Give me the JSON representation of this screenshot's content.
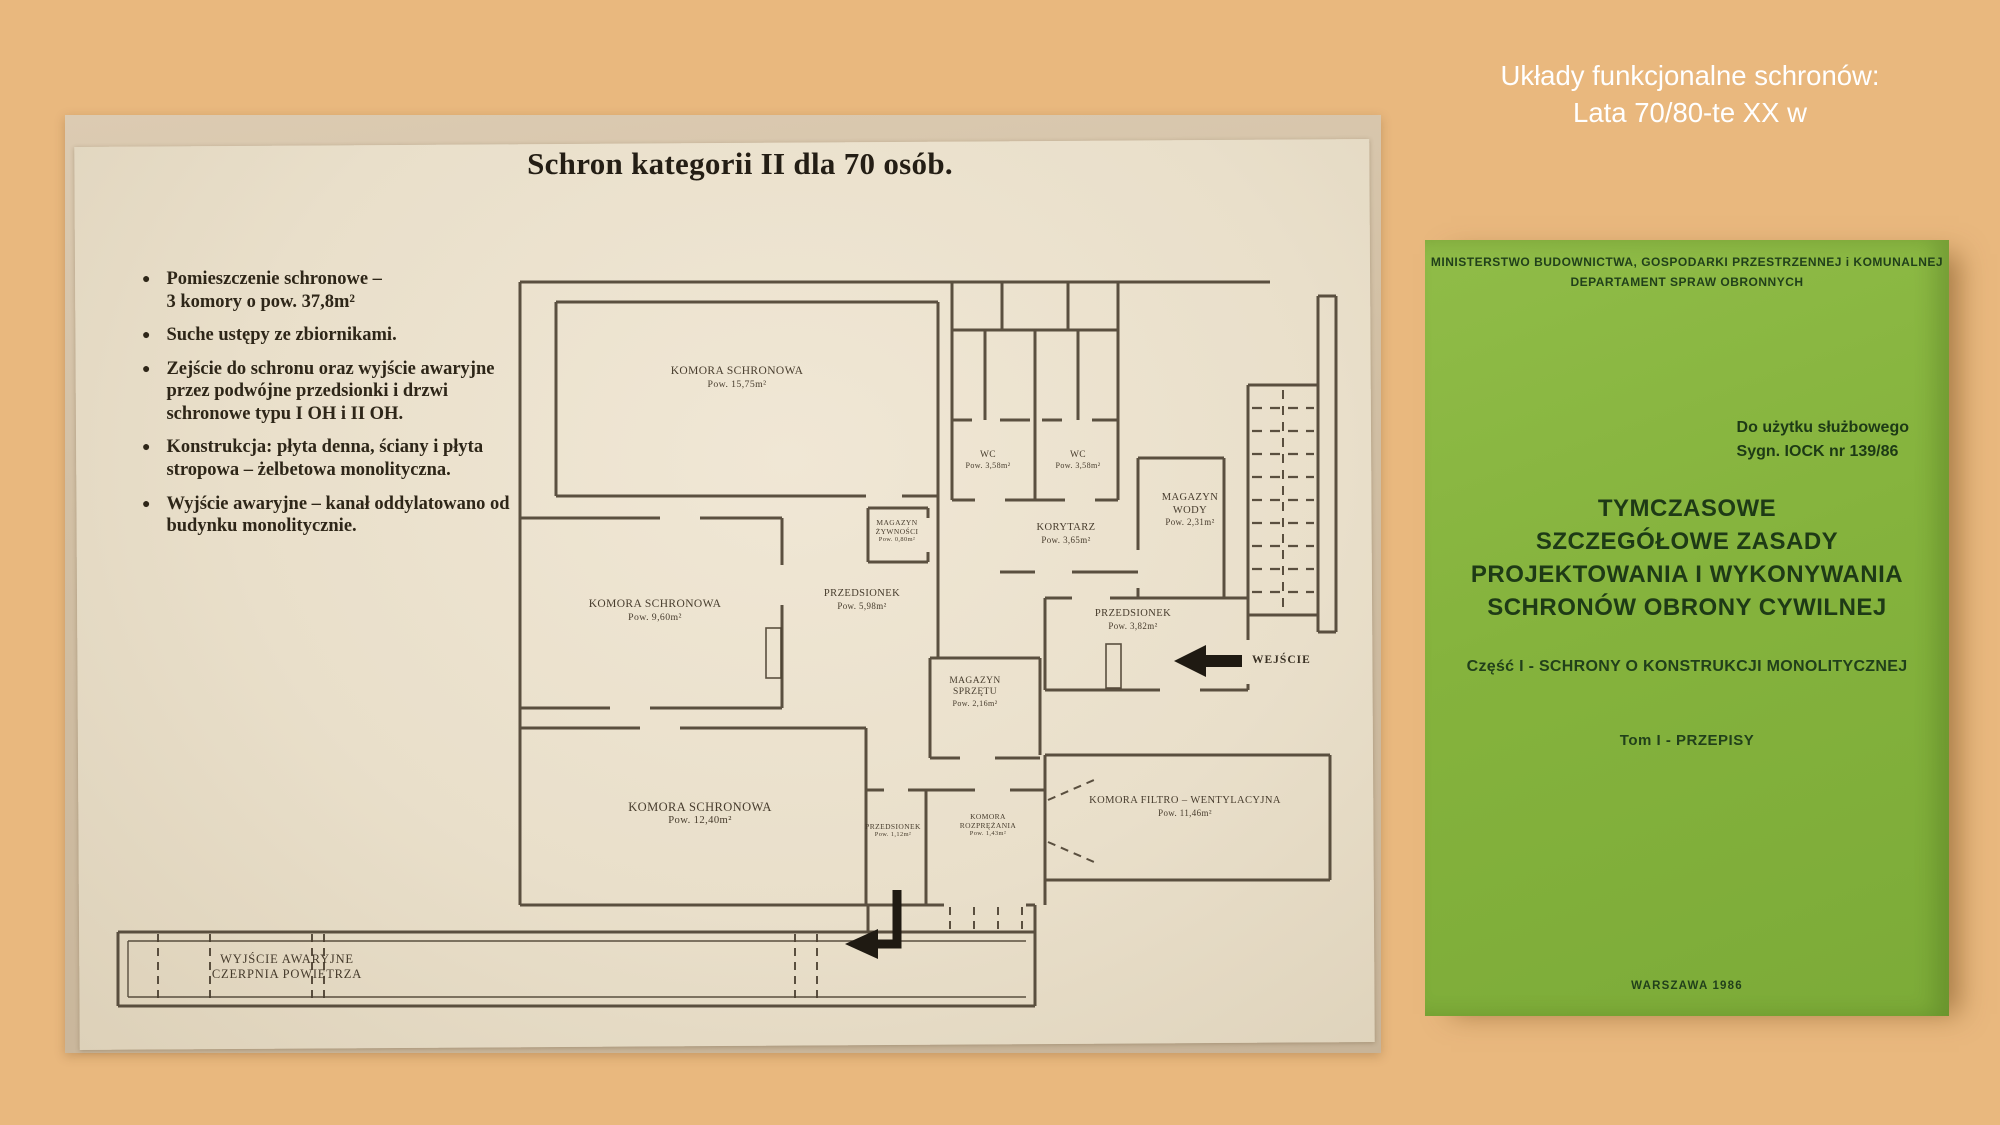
{
  "caption": {
    "line1": "Układy funkcjonalne schronów:",
    "line2": "Lata 70/80-te XX w"
  },
  "colors": {
    "page_bg": "#e9b87e",
    "cover_green": "#86b53e",
    "paper": "#e9dfca",
    "plan_ink": "#473c2d",
    "caption_text": "#ffffff"
  },
  "floorplan": {
    "title": "Schron kategorii II dla 70 osób.",
    "bullets": [
      "Pomieszczenie schronowe –\n3 komory o pow. 37,8m²",
      "Suche ustępy ze zbiornikami.",
      "Zejście do schronu oraz wyjście awaryjne\nprzez podwójne przedsionki i drzwi\nschronowe typu I OH i II OH.",
      "Konstrukcja: płyta denna, ściany i płyta\nstropowa – żelbetowa monolityczna.",
      "Wyjście awaryjne – kanał oddylatowano od\nbudynku monolitycznie."
    ],
    "rooms": [
      {
        "name": "KOMORA SCHRONOWA",
        "area": "Pow. 15,75m²"
      },
      {
        "name": "WC",
        "area": "Pow. 3,58m²"
      },
      {
        "name": "WC",
        "area": "Pow. 3,58m²"
      },
      {
        "name": "MAGAZYN\nŻYWNOŚCI",
        "area": "Pow. 0,80m²"
      },
      {
        "name": "KORYTARZ",
        "area": "Pow. 3,65m²"
      },
      {
        "name": "MAGAZYN\nWODY",
        "area": "Pow. 2,31m²"
      },
      {
        "name": "KOMORA SCHRONOWA",
        "area": "Pow. 9,60m²"
      },
      {
        "name": "PRZEDSIONEK",
        "area": "Pow. 5,98m²"
      },
      {
        "name": "PRZEDSIONEK",
        "area": "Pow. 3,82m²"
      },
      {
        "name": "MAGAZYN\nSPRZĘTU",
        "area": "Pow. 2,16m²"
      },
      {
        "name": "KOMORA SCHRONOWA",
        "area": "Pow. 12,40m²"
      },
      {
        "name": "PRZEDSIONEK",
        "area": "Pow. 1,12m²"
      },
      {
        "name": "KOMORA\nROZPRĘŻANIA",
        "area": "Pow. 1,43m²"
      },
      {
        "name": "KOMORA FILTRO – WENTYLACYJNA",
        "area": "Pow. 11,46m²"
      }
    ],
    "entrance_label": "WEJŚCIE",
    "emergency_exit_label": "WYJŚCIE AWARYJNE\nCZERPNIA POWIETRZA"
  },
  "book_cover": {
    "ministry_line1": "MINISTERSTWO BUDOWNICTWA, GOSPODARKI PRZESTRZENNEJ i KOMUNALNEJ",
    "ministry_line2": "DEPARTAMENT SPRAW OBRONNYCH",
    "usage_note": "Do użytku służbowego\nSygn. IOCK nr 139/86",
    "title": "TYMCZASOWE\nSZCZEGÓŁOWE ZASADY\nPROJEKTOWANIA I WYKONYWANIA\nSCHRONÓW OBRONY CYWILNEJ",
    "part_line": "Część I - SCHRONY O KONSTRUKCJI MONOLITYCZNEJ",
    "volume_line": "Tom I - PRZEPISY",
    "footer": "WARSZAWA 1986"
  }
}
